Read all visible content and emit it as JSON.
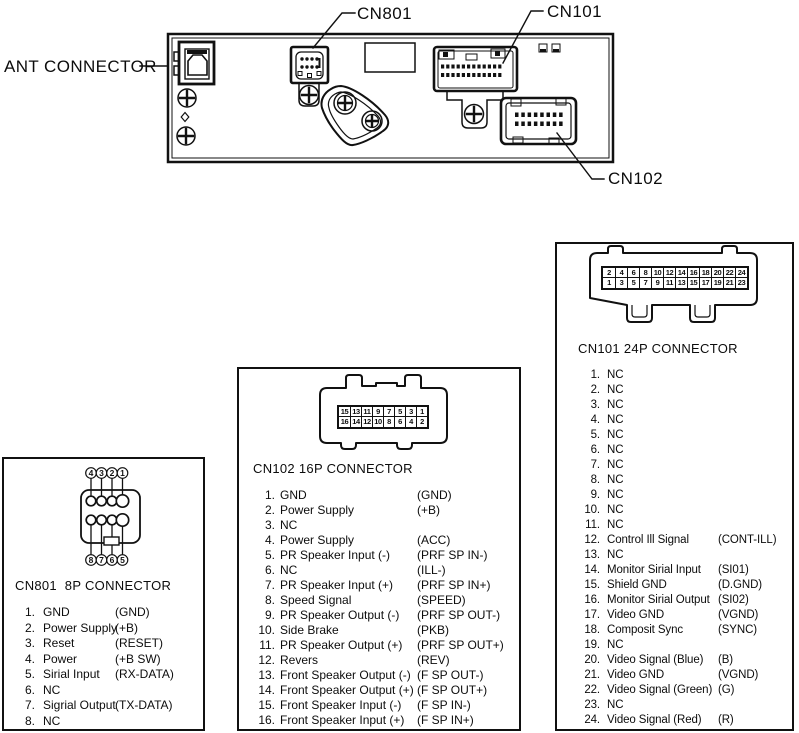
{
  "panel": {
    "labels": {
      "ant": "ANT CONNECTOR",
      "cn801": "CN801",
      "cn101": "CN101",
      "cn102": "CN102"
    }
  },
  "colors": {
    "line": "#111111",
    "background": "#ffffff"
  },
  "connectors": [
    {
      "id": "cn801",
      "title": "CN801  8P CONNECTOR",
      "diagram_top": [
        "4",
        "3",
        "2",
        "1"
      ],
      "diagram_bottom": [
        "8",
        "7",
        "6",
        "5"
      ],
      "pins": [
        {
          "num": "1.",
          "name": "GND",
          "code": "(GND)"
        },
        {
          "num": "2.",
          "name": "Power Supply",
          "code": "(+B)"
        },
        {
          "num": "3.",
          "name": "Reset",
          "code": "(RESET)"
        },
        {
          "num": "4.",
          "name": "Power",
          "code": "(+B SW)"
        },
        {
          "num": "5.",
          "name": "Sirial Input",
          "code": "(RX-DATA)"
        },
        {
          "num": "6.",
          "name": "NC",
          "code": ""
        },
        {
          "num": "7.",
          "name": "Sigrial Output",
          "code": "(TX-DATA)"
        },
        {
          "num": "8.",
          "name": "NC",
          "code": ""
        }
      ]
    },
    {
      "id": "cn102",
      "title": "CN102 16P CONNECTOR",
      "grid_top": [
        "15",
        "13",
        "11",
        "9",
        "7",
        "5",
        "3",
        "1"
      ],
      "grid_bottom": [
        "16",
        "14",
        "12",
        "10",
        "8",
        "6",
        "4",
        "2"
      ],
      "pins": [
        {
          "num": "1.",
          "name": "GND",
          "code": "(GND)"
        },
        {
          "num": "2.",
          "name": "Power Supply",
          "code": "(+B)"
        },
        {
          "num": "3.",
          "name": "NC",
          "code": ""
        },
        {
          "num": "4.",
          "name": "Power Supply",
          "code": "(ACC)"
        },
        {
          "num": "5.",
          "name": "PR Speaker Input (-)",
          "code": "(PRF SP IN-)"
        },
        {
          "num": "6.",
          "name": "NC",
          "code": "(ILL-)"
        },
        {
          "num": "7.",
          "name": "PR Speaker Input (+)",
          "code": "(PRF SP IN+)"
        },
        {
          "num": "8.",
          "name": "Speed Signal",
          "code": "(SPEED)"
        },
        {
          "num": "9.",
          "name": "PR Speaker Output (-)",
          "code": "(PRF SP OUT-)"
        },
        {
          "num": "10.",
          "name": "Side Brake",
          "code": "(PKB)"
        },
        {
          "num": "11.",
          "name": "PR Speaker Output (+)",
          "code": "(PRF SP OUT+)"
        },
        {
          "num": "12.",
          "name": "Revers",
          "code": "(REV)"
        },
        {
          "num": "13.",
          "name": "Front Speaker Output (-)",
          "code": "(F SP OUT-)"
        },
        {
          "num": "14.",
          "name": "Front Speaker Output (+)",
          "code": "(F SP OUT+)"
        },
        {
          "num": "15.",
          "name": "Front Speaker Input (-)",
          "code": "(F SP IN-)"
        },
        {
          "num": "16.",
          "name": "Front Speaker Input (+)",
          "code": "(F SP IN+)"
        }
      ]
    },
    {
      "id": "cn101",
      "title": "CN101 24P CONNECTOR",
      "grid_top": [
        "2",
        "4",
        "6",
        "8",
        "10",
        "12",
        "14",
        "16",
        "18",
        "20",
        "22",
        "24"
      ],
      "grid_bottom": [
        "1",
        "3",
        "5",
        "7",
        "9",
        "11",
        "13",
        "15",
        "17",
        "19",
        "21",
        "23"
      ],
      "pins": [
        {
          "num": "1.",
          "name": "NC",
          "code": ""
        },
        {
          "num": "2.",
          "name": "NC",
          "code": ""
        },
        {
          "num": "3.",
          "name": "NC",
          "code": ""
        },
        {
          "num": "4.",
          "name": "NC",
          "code": ""
        },
        {
          "num": "5.",
          "name": "NC",
          "code": ""
        },
        {
          "num": "6.",
          "name": "NC",
          "code": ""
        },
        {
          "num": "7.",
          "name": "NC",
          "code": ""
        },
        {
          "num": "8.",
          "name": "NC",
          "code": ""
        },
        {
          "num": "9.",
          "name": "NC",
          "code": ""
        },
        {
          "num": "10.",
          "name": "NC",
          "code": ""
        },
        {
          "num": "11.",
          "name": "NC",
          "code": ""
        },
        {
          "num": "12.",
          "name": "Control Ill Signal",
          "code": "(CONT-ILL)"
        },
        {
          "num": "13.",
          "name": "NC",
          "code": ""
        },
        {
          "num": "14.",
          "name": "Monitor Sirial Input",
          "code": "(SI01)"
        },
        {
          "num": "15.",
          "name": "Shield GND",
          "code": "(D.GND)"
        },
        {
          "num": "16.",
          "name": "Monitor Sirial Output",
          "code": "(SI02)"
        },
        {
          "num": "17.",
          "name": "Video GND",
          "code": "(VGND)"
        },
        {
          "num": "18.",
          "name": "Composit Sync",
          "code": "(SYNC)"
        },
        {
          "num": "19.",
          "name": "NC",
          "code": ""
        },
        {
          "num": "20.",
          "name": "Video Signal (Blue)",
          "code": "(B)"
        },
        {
          "num": "21.",
          "name": "Video GND",
          "code": "(VGND)"
        },
        {
          "num": "22.",
          "name": "Video Signal (Green)",
          "code": "(G)"
        },
        {
          "num": "23.",
          "name": "NC",
          "code": ""
        },
        {
          "num": "24.",
          "name": "Video Signal (Red)",
          "code": "(R)"
        }
      ]
    }
  ]
}
